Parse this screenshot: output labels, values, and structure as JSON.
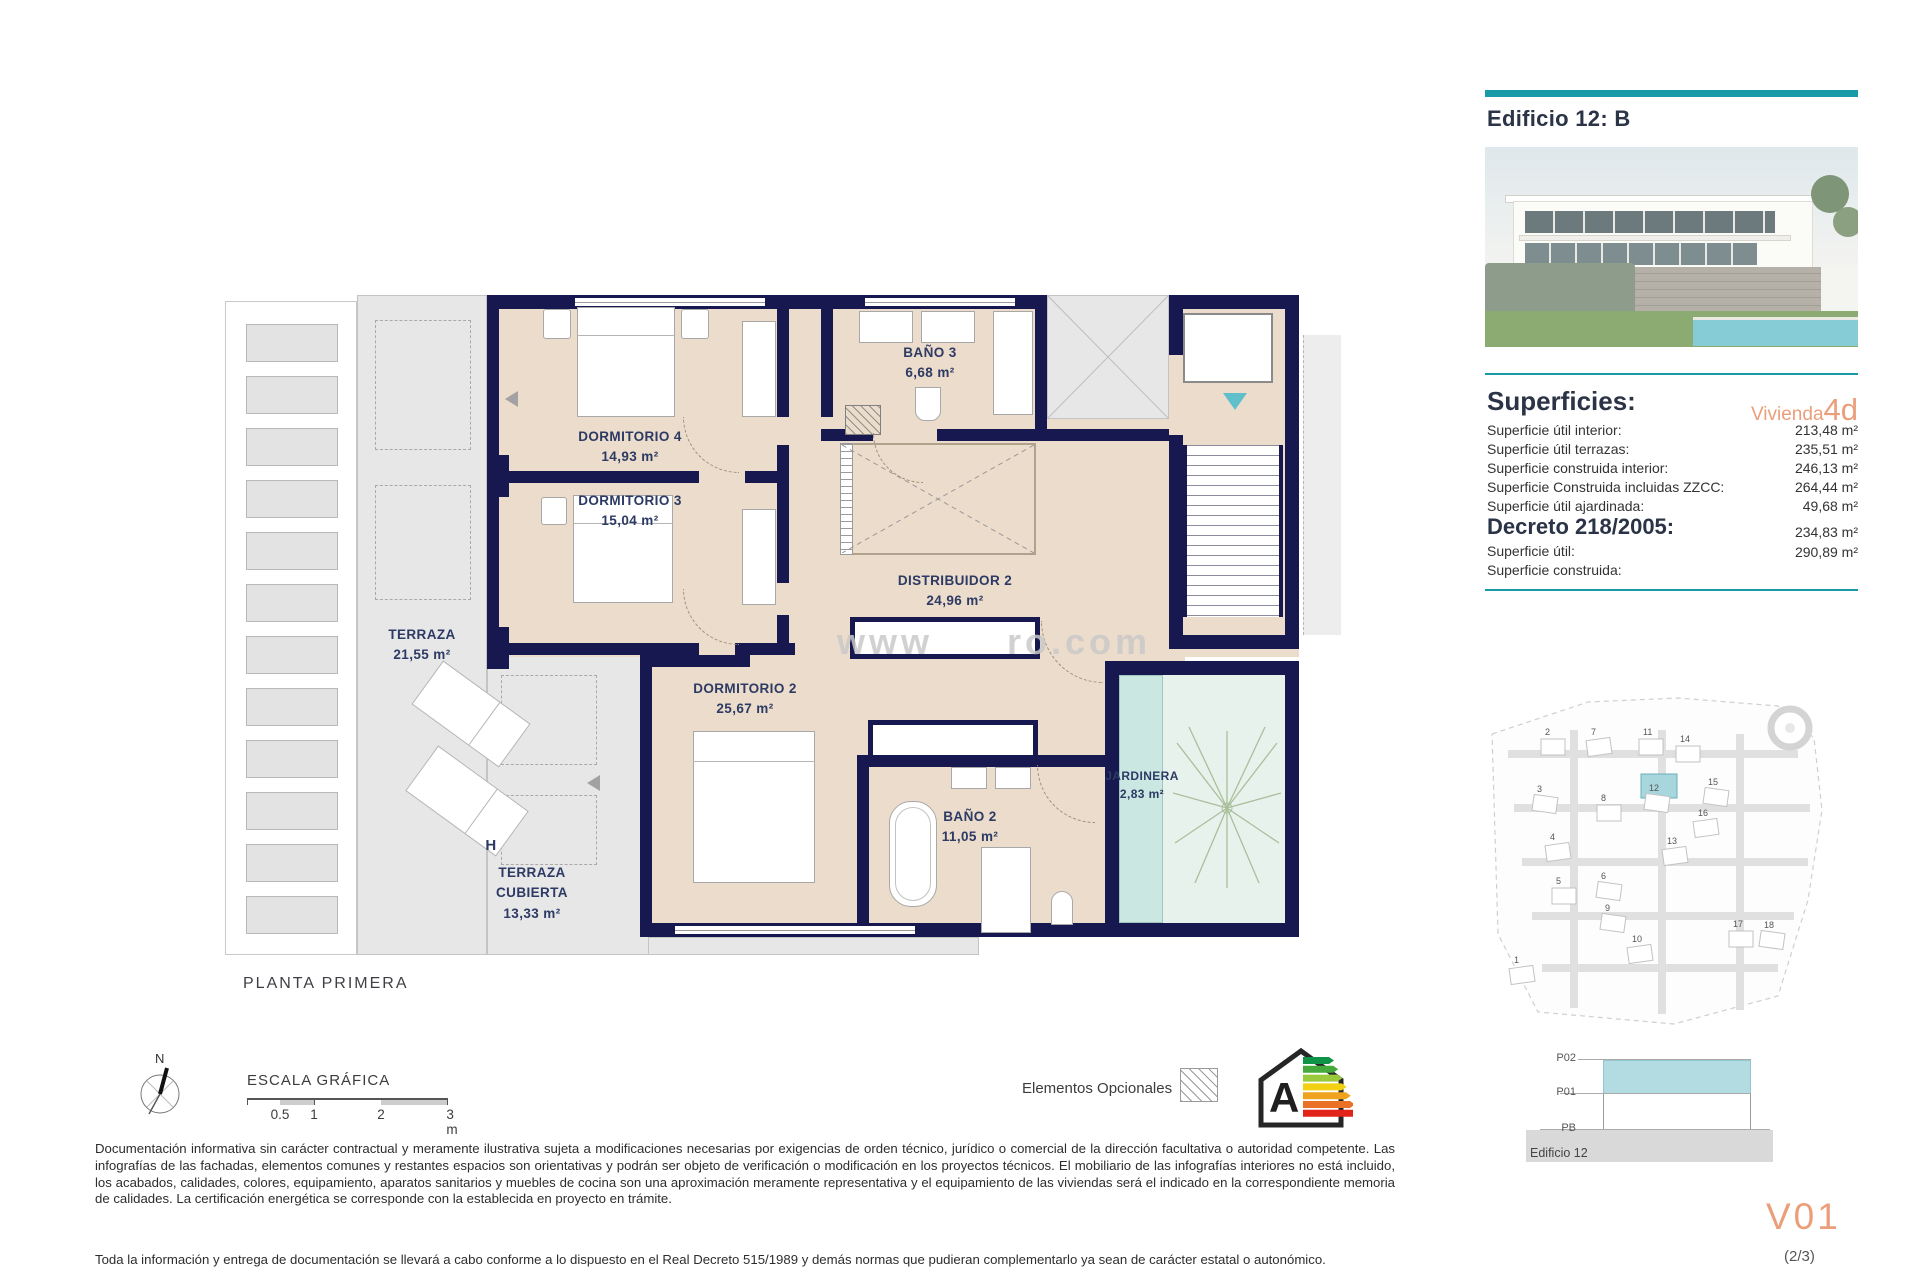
{
  "accent": {
    "teal": "#189AA7",
    "salmon": "#EB9E7A",
    "wall_navy": "#181850",
    "room_beige": "#ECDCCB",
    "terrace_gray": "#E7E7E7",
    "jardinera_teal": "#CBE7E1",
    "site_highlight": "#A7D6DC"
  },
  "header": {
    "title": "Edificio 12: B"
  },
  "superficies": {
    "title": "Superficies:",
    "vivienda_label": "Vivienda",
    "vivienda_code": "4d",
    "rows": [
      {
        "label": "Superficie útil interior:",
        "value": "213,48 m²"
      },
      {
        "label": "Superficie útil terrazas:",
        "value": "235,51 m²"
      },
      {
        "label": "Superficie construida interior:",
        "value": "246,13 m²"
      },
      {
        "label": "Superficie Construida incluidas ZZCC:",
        "value": "264,44 m²"
      },
      {
        "label": "Superficie útil ajardinada:",
        "value": "49,68 m²"
      }
    ],
    "decreto": {
      "title": "Decreto 218/2005:",
      "rows": [
        {
          "label": "Superficie útil:",
          "value": "234,83 m²"
        },
        {
          "label": "Superficie construida:",
          "value": "290,89 m²"
        }
      ]
    }
  },
  "plan": {
    "title": "PLANTA PRIMERA",
    "h_label": "H",
    "rooms": [
      {
        "name": "DORMITORIO 4",
        "area": "14,93 m²"
      },
      {
        "name": "DORMITORIO 3",
        "area": "15,04 m²"
      },
      {
        "name": "BAÑO 3",
        "area": "6,68 m²"
      },
      {
        "name": "DISTRIBUIDOR 2",
        "area": "24,96 m²"
      },
      {
        "name": "DORMITORIO 2",
        "area": "25,67 m²"
      },
      {
        "name": "BAÑO 2",
        "area": "11,05 m²"
      },
      {
        "name": "TERRAZA",
        "area": "21,55 m²"
      },
      {
        "name": "TERRAZA CUBIERTA",
        "area": "13,33 m²"
      },
      {
        "name": "JARDINERA",
        "area": "2,83 m²"
      }
    ],
    "watermark": {
      "left": "www",
      "right": "ro.com"
    }
  },
  "legend": {
    "north_label": "N",
    "scale_title": "ESCALA GRÁFICA",
    "scale_ticks": [
      "0.5",
      "1",
      "2",
      "3 m"
    ],
    "optional_label": "Elementos Opcionales",
    "energy_letter": "A",
    "energy_colors": [
      "#0F9447",
      "#45A93C",
      "#9ACA3C",
      "#F2D113",
      "#F0A31E",
      "#EA7125",
      "#E2231A"
    ]
  },
  "disclaimer": {
    "p1": "Documentación informativa sin carácter contractual y meramente ilustrativa sujeta a modificaciones necesarias por exigencias de orden técnico, jurídico o comercial de la dirección facultativa o autoridad competente. Las infografías de las fachadas, elementos comunes y restantes espacios son orientativas y podrán ser objeto de verificación o modificación en los proyectos técnicos. El mobiliario de las infografías interiores no está incluido, los acabados, calidades, colores, equipamiento, aparatos sanitarios y muebles de cocina son una aproximación meramente representativa y el equipamiento de las viviendas será el indicado en la correspondiente memoria de calidades. La certificación energética se corresponde con la establecida en proyecto en trámite.",
    "p2": "Toda la información y entrega de documentación se llevará a cabo conforme a lo dispuesto en el Real Decreto 515/1989 y demás normas que pudieran complementarlo ya sean de carácter estatal o autonómico."
  },
  "sitemap": {
    "highlight": "12",
    "plots": [
      {
        "n": "1",
        "x": 36,
        "y": 273
      },
      {
        "n": "2",
        "x": 67,
        "y": 45
      },
      {
        "n": "3",
        "x": 59,
        "y": 102
      },
      {
        "n": "4",
        "x": 72,
        "y": 150
      },
      {
        "n": "5",
        "x": 78,
        "y": 194
      },
      {
        "n": "6",
        "x": 123,
        "y": 189
      },
      {
        "n": "7",
        "x": 113,
        "y": 45
      },
      {
        "n": "8",
        "x": 123,
        "y": 111
      },
      {
        "n": "9",
        "x": 127,
        "y": 221
      },
      {
        "n": "10",
        "x": 154,
        "y": 252
      },
      {
        "n": "11",
        "x": 165,
        "y": 45
      },
      {
        "n": "12",
        "x": 171,
        "y": 101
      },
      {
        "n": "13",
        "x": 189,
        "y": 154
      },
      {
        "n": "14",
        "x": 202,
        "y": 52
      },
      {
        "n": "15",
        "x": 230,
        "y": 95
      },
      {
        "n": "16",
        "x": 220,
        "y": 126
      },
      {
        "n": "17",
        "x": 255,
        "y": 237
      },
      {
        "n": "18",
        "x": 286,
        "y": 238
      }
    ]
  },
  "section": {
    "levels": [
      "P02",
      "P01",
      "PB"
    ],
    "caption": "Edificio 12"
  },
  "footer": {
    "sheet": "V01",
    "page": "(2/3)"
  }
}
